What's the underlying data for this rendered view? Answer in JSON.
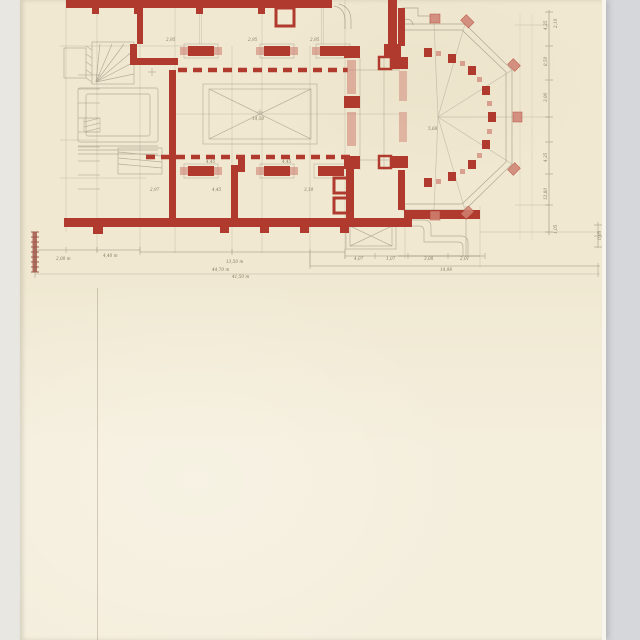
{
  "scan": {
    "background_color": "#d5d7da",
    "left_strip_color": "#e9e7e2",
    "paper_color": "#f0e8d1",
    "paper_color_lower": "#f4eedd",
    "paper_edge_highlight": "#f8f5ec",
    "ink_red": "#b13a2e",
    "ink_red_light": "#cf8273",
    "pencil_color": "#7d7463",
    "scale_bar_color": "#a4584b"
  },
  "drawing": {
    "type": "architectural floor plan, church with polygonal apse, red ink walls on aged paper",
    "scale_bar_tick_count": 9
  },
  "labels": {
    "interior": [
      {
        "text": "2,95",
        "x": 166,
        "y": 41,
        "size": 3.8
      },
      {
        "text": "2,95",
        "x": 248,
        "y": 41,
        "size": 3.8
      },
      {
        "text": "2,95",
        "x": 310,
        "y": 41,
        "size": 3.8
      },
      {
        "text": "14,50",
        "x": 252,
        "y": 120,
        "size": 4
      },
      {
        "text": "4,45",
        "x": 206,
        "y": 163,
        "size": 3.8
      },
      {
        "text": "4,45",
        "x": 282,
        "y": 163,
        "size": 3.8
      },
      {
        "text": "2,97",
        "x": 150,
        "y": 191,
        "size": 3.8
      },
      {
        "text": "4,45",
        "x": 212,
        "y": 191,
        "size": 3.8
      },
      {
        "text": "3,10",
        "x": 304,
        "y": 191,
        "size": 3.8
      },
      {
        "text": "5,68",
        "x": 428,
        "y": 130,
        "size": 3.8
      }
    ],
    "bottom": [
      {
        "text": "2,08 m",
        "x": 56,
        "y": 260
      },
      {
        "text": "4,40 m",
        "x": 103,
        "y": 257
      },
      {
        "text": "13,50 m",
        "x": 226,
        "y": 263
      },
      {
        "text": "44,70 m",
        "x": 212,
        "y": 271
      },
      {
        "text": "41,50 m",
        "x": 232,
        "y": 278
      },
      {
        "text": "4,07",
        "x": 354,
        "y": 260,
        "size": 3.8
      },
      {
        "text": "1,07",
        "x": 386,
        "y": 260,
        "size": 3.8
      },
      {
        "text": "3,08",
        "x": 424,
        "y": 260,
        "size": 3.8
      },
      {
        "text": "2,01",
        "x": 460,
        "y": 260,
        "size": 3.8
      },
      {
        "text": "14,98",
        "x": 440,
        "y": 271
      }
    ],
    "right_column": [
      {
        "text": "4,35",
        "x": 547,
        "y": 30,
        "rotate": -90,
        "size": 3.8
      },
      {
        "text": "2,10",
        "x": 557,
        "y": 28,
        "rotate": -90,
        "size": 3.6
      },
      {
        "text": "8,50",
        "x": 547,
        "y": 66,
        "rotate": -90,
        "size": 3.8
      },
      {
        "text": "3,90",
        "x": 547,
        "y": 102,
        "rotate": -90,
        "size": 3.8
      },
      {
        "text": "4,35",
        "x": 547,
        "y": 162,
        "rotate": -90,
        "size": 3.8
      },
      {
        "text": "12,80",
        "x": 547,
        "y": 200,
        "rotate": -90,
        "size": 3.8
      },
      {
        "text": "1,05",
        "x": 557,
        "y": 234,
        "rotate": -90,
        "size": 3.6
      },
      {
        "text": "0,95",
        "x": 601,
        "y": 240,
        "rotate": -90,
        "size": 3.6
      }
    ]
  }
}
